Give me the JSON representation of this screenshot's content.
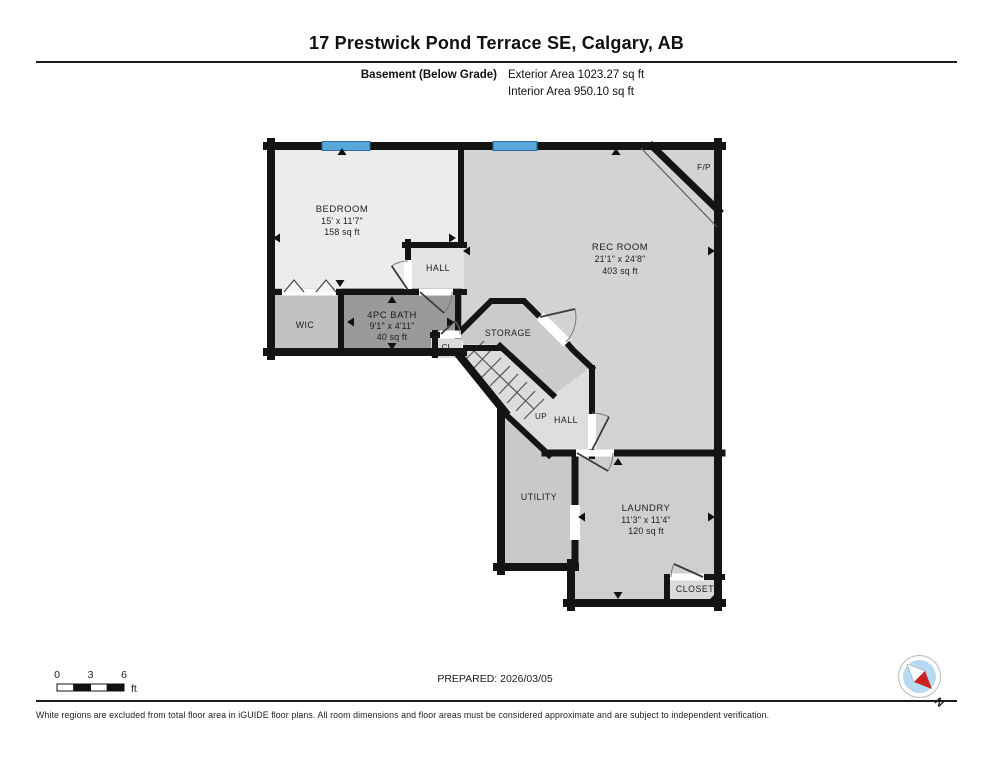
{
  "header": {
    "title": "17 Prestwick Pond Terrace SE, Calgary, AB",
    "floor_label": "Basement (Below Grade)",
    "exterior_area": "Exterior Area 1023.27 sq ft",
    "interior_area": "Interior Area 950.10 sq ft"
  },
  "rooms": {
    "bedroom": {
      "name": "BEDROOM",
      "dims": "15' x 11'7\"",
      "area": "158 sq ft"
    },
    "rec_room": {
      "name": "REC ROOM",
      "dims": "21'1\" x 24'8\"",
      "area": "403 sq ft"
    },
    "bath": {
      "name": "4PC BATH",
      "dims": "9'1\" x 4'11\"",
      "area": "40 sq ft"
    },
    "laundry": {
      "name": "LAUNDRY",
      "dims": "11'3\" x 11'4\"",
      "area": "120 sq ft"
    },
    "wic": {
      "name": "WIC"
    },
    "hall_upper": {
      "name": "HALL"
    },
    "hall_lower": {
      "name": "HALL"
    },
    "storage": {
      "name": "STORAGE"
    },
    "closet_small": {
      "name": "CL"
    },
    "closet": {
      "name": "CLOSET"
    },
    "utility": {
      "name": "UTILITY"
    },
    "stairs_up": {
      "name": "UP"
    },
    "fireplace": {
      "name": "F/P"
    }
  },
  "scale_bar": {
    "t0": "0",
    "t3": "3",
    "t6": "6",
    "unit": "ft"
  },
  "compass": {
    "north_label": "N"
  },
  "footer": {
    "prepared": "PREPARED: 2026/03/05",
    "disclaimer": "White regions are excluded from total floor area in iGUIDE floor plans. All room dimensions and floor areas must be considered approximate and are subject to independent verification."
  },
  "colors": {
    "wall": "#141414",
    "window_blue": "#58a9da",
    "bath_fill": "#9a9a9a",
    "compass_red": "#cc2222",
    "compass_blue": "#b5daf2"
  }
}
